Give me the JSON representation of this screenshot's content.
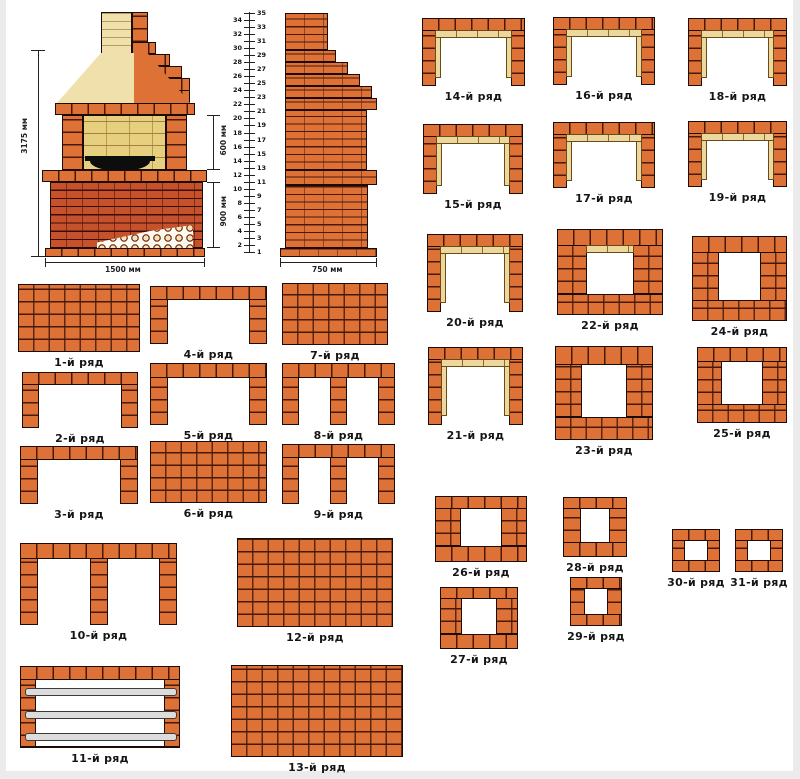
{
  "colors": {
    "brick_orange": "#de7136",
    "brick_joint": "#47190a",
    "brick_red": "#c6512b",
    "firebrick_tan": "#ecd79c",
    "hood_cream": "#efe0ac",
    "firebox_yellow": "#e7cf80",
    "metal_rod_gray": "#dcdcdc",
    "outline": "#1c0c04",
    "background": "#ffffff"
  },
  "elevation": {
    "dims": {
      "height": "3175 мм",
      "firebox_height": "600 мм",
      "pedestal_height": "900 мм",
      "width": "1500 мм"
    }
  },
  "side_view": {
    "dim_width": "750 мм",
    "ruler_numbers": [
      1,
      2,
      3,
      4,
      5,
      6,
      7,
      8,
      9,
      10,
      11,
      12,
      13,
      14,
      15,
      16,
      17,
      18,
      19,
      20,
      21,
      22,
      23,
      24,
      25,
      26,
      27,
      28,
      29,
      30,
      31,
      32,
      33,
      34,
      35
    ]
  },
  "rows": [
    {
      "num": 1,
      "label": "1-й ряд",
      "shape": "solid",
      "x": 18,
      "y": 284,
      "w": 122,
      "h": 68
    },
    {
      "num": 2,
      "label": "2-й ряд",
      "shape": "u",
      "x": 22,
      "y": 372,
      "w": 116,
      "h": 56
    },
    {
      "num": 3,
      "label": "3-й ряд",
      "shape": "u",
      "x": 20,
      "y": 446,
      "w": 118,
      "h": 58
    },
    {
      "num": 4,
      "label": "4-й ряд",
      "shape": "u",
      "x": 150,
      "y": 286,
      "w": 117,
      "h": 58
    },
    {
      "num": 5,
      "label": "5-й ряд",
      "shape": "u",
      "x": 150,
      "y": 363,
      "w": 117,
      "h": 62
    },
    {
      "num": 6,
      "label": "6-й ряд",
      "shape": "solid",
      "x": 150,
      "y": 441,
      "w": 117,
      "h": 62
    },
    {
      "num": 7,
      "label": "7-й ряд",
      "shape": "solid",
      "x": 282,
      "y": 283,
      "w": 106,
      "h": 62
    },
    {
      "num": 8,
      "label": "8-й ряд",
      "shape": "u3",
      "x": 282,
      "y": 363,
      "w": 113,
      "h": 62
    },
    {
      "num": 9,
      "label": "9-й ряд",
      "shape": "u3",
      "x": 282,
      "y": 444,
      "w": 113,
      "h": 60
    },
    {
      "num": 10,
      "label": "10-й ряд",
      "shape": "u3",
      "x": 20,
      "y": 543,
      "w": 157,
      "h": 82
    },
    {
      "num": 11,
      "label": "11-й ряд",
      "shape": "rods",
      "x": 20,
      "y": 666,
      "w": 160,
      "h": 82
    },
    {
      "num": 12,
      "label": "12-й ряд",
      "shape": "solid",
      "x": 237,
      "y": 538,
      "w": 156,
      "h": 89
    },
    {
      "num": 13,
      "label": "13-й ряд",
      "shape": "solid",
      "x": 231,
      "y": 665,
      "w": 172,
      "h": 92
    },
    {
      "num": 14,
      "label": "14-й ряд",
      "shape": "u-lined",
      "x": 422,
      "y": 18,
      "w": 103,
      "h": 68
    },
    {
      "num": 15,
      "label": "15-й ряд",
      "shape": "u-lined",
      "x": 423,
      "y": 124,
      "w": 100,
      "h": 70
    },
    {
      "num": 16,
      "label": "16-й ряд",
      "shape": "u-lined",
      "x": 553,
      "y": 17,
      "w": 102,
      "h": 68
    },
    {
      "num": 17,
      "label": "17-й ряд",
      "shape": "u-lined",
      "x": 553,
      "y": 122,
      "w": 102,
      "h": 66
    },
    {
      "num": 18,
      "label": "18-й ряд",
      "shape": "u-lined",
      "x": 688,
      "y": 18,
      "w": 99,
      "h": 68
    },
    {
      "num": 19,
      "label": "19-й ряд",
      "shape": "u-lined",
      "x": 688,
      "y": 121,
      "w": 99,
      "h": 66
    },
    {
      "num": 20,
      "label": "20-й ряд",
      "shape": "u-lined",
      "x": 427,
      "y": 234,
      "w": 96,
      "h": 78
    },
    {
      "num": 21,
      "label": "21-й ряд",
      "shape": "u-lined",
      "x": 428,
      "y": 347,
      "w": 95,
      "h": 78
    },
    {
      "num": 22,
      "label": "22-й ряд",
      "shape": "ring-lined",
      "x": 557,
      "y": 229,
      "w": 106,
      "h": 86
    },
    {
      "num": 23,
      "label": "23-й ряд",
      "shape": "ring",
      "x": 555,
      "y": 346,
      "w": 98,
      "h": 94
    },
    {
      "num": 24,
      "label": "24-й ряд",
      "shape": "ring",
      "x": 692,
      "y": 236,
      "w": 95,
      "h": 85
    },
    {
      "num": 25,
      "label": "25-й ряд",
      "shape": "ring",
      "x": 697,
      "y": 347,
      "w": 90,
      "h": 76
    },
    {
      "num": 26,
      "label": "26-й ряд",
      "shape": "ring",
      "x": 435,
      "y": 496,
      "w": 92,
      "h": 66
    },
    {
      "num": 27,
      "label": "27-й ряд",
      "shape": "ring",
      "x": 440,
      "y": 587,
      "w": 78,
      "h": 62
    },
    {
      "num": 28,
      "label": "28-й ряд",
      "shape": "ring",
      "x": 563,
      "y": 497,
      "w": 64,
      "h": 60
    },
    {
      "num": 29,
      "label": "29-й ряд",
      "shape": "ring",
      "x": 570,
      "y": 577,
      "w": 52,
      "h": 49
    },
    {
      "num": 30,
      "label": "30-й ряд",
      "shape": "ring",
      "x": 672,
      "y": 529,
      "w": 48,
      "h": 43
    },
    {
      "num": 31,
      "label": "31-й ряд",
      "shape": "ring",
      "x": 735,
      "y": 529,
      "w": 48,
      "h": 43
    }
  ]
}
